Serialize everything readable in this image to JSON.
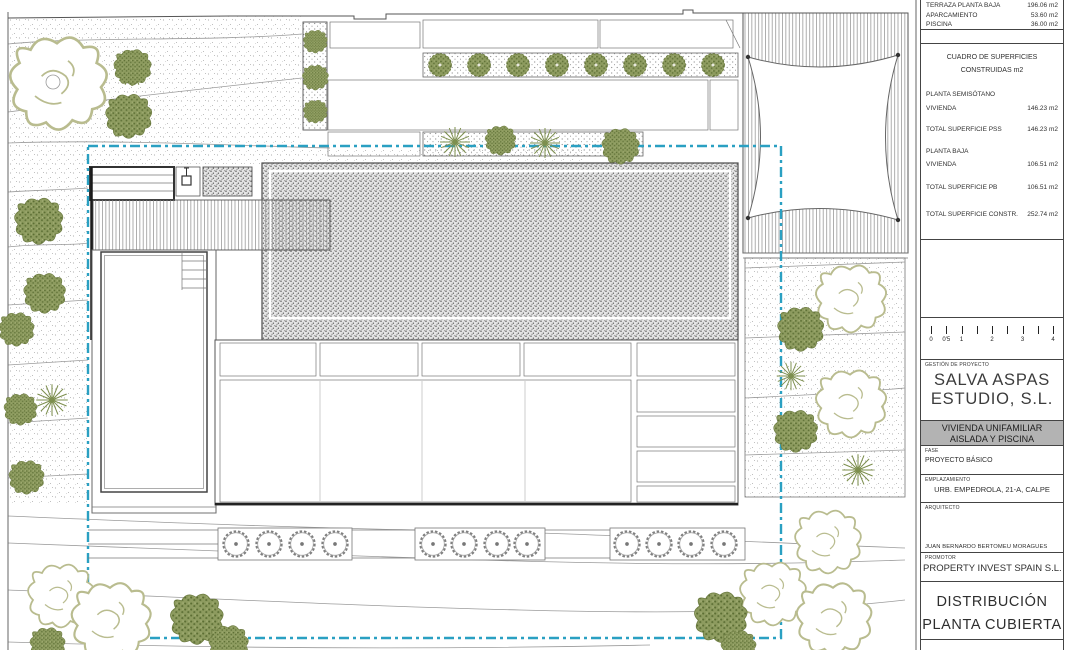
{
  "title_block": {
    "areas_table": {
      "rows": [
        {
          "label": "TERRAZA PLANTA BAJA",
          "value": "196.06 m2"
        },
        {
          "label": "APARCAMIENTO",
          "value": "53.60 m2"
        },
        {
          "label": "PISCINA",
          "value": "36.00 m2"
        }
      ]
    },
    "surfaces": {
      "title": "CUADRO DE SUPERFICIES",
      "subtitle": "CONSTRUIDAS m2",
      "rows": [
        {
          "label": "PLANTA SEMISÓTANO",
          "value": ""
        },
        {
          "label": "VIVIENDA",
          "value": "146.23 m2"
        },
        {
          "label": "TOTAL SUPERFICIE PSS",
          "value": "146.23 m2"
        },
        {
          "label": "PLANTA BAJA",
          "value": ""
        },
        {
          "label": "VIVIENDA",
          "value": "106.51 m2"
        },
        {
          "label": "TOTAL SUPERFICIE PB",
          "value": "106.51 m2"
        },
        {
          "label": "TOTAL SUPERFICIE CONSTR.",
          "value": "252.74 m2"
        }
      ]
    },
    "scale_bar": {
      "labels": [
        "0",
        "0'5",
        "1",
        "2",
        "3",
        "4"
      ]
    },
    "management": {
      "label": "GESTIÓN DE PROYECTO",
      "company_line1": "SALVA ASPAS",
      "company_line2": "ESTUDIO, S.L."
    },
    "project_title": {
      "line1": "VIVIENDA UNIFAMILIAR",
      "line2": "AISLADA Y PISCINA"
    },
    "fase": {
      "label": "FASE",
      "value": "PROYECTO BÁSICO"
    },
    "emplazamiento": {
      "label": "EMPLAZAMIENTO",
      "value": "URB. EMPEDROLA, 21-A, CALPE"
    },
    "arquitecto": {
      "label": "ARQUITECTO",
      "name": "JUAN BERNARDO BERTOMEU MORAGUES"
    },
    "promotor": {
      "label": "PROMOTOR",
      "name": "PROPERTY INVEST SPAIN S.L."
    },
    "sheet_title": {
      "line1": "DISTRIBUCIÓN",
      "line2": "PLANTA CUBIERTA"
    }
  },
  "colors": {
    "boundary_dashed": "#2aa0c2",
    "title_band_grey": "#b3b3b3",
    "vegetation_olive": "#7e9150",
    "tree_outline_olive": "#b9bc8f",
    "gravel_grey": "#5a5a5a"
  }
}
